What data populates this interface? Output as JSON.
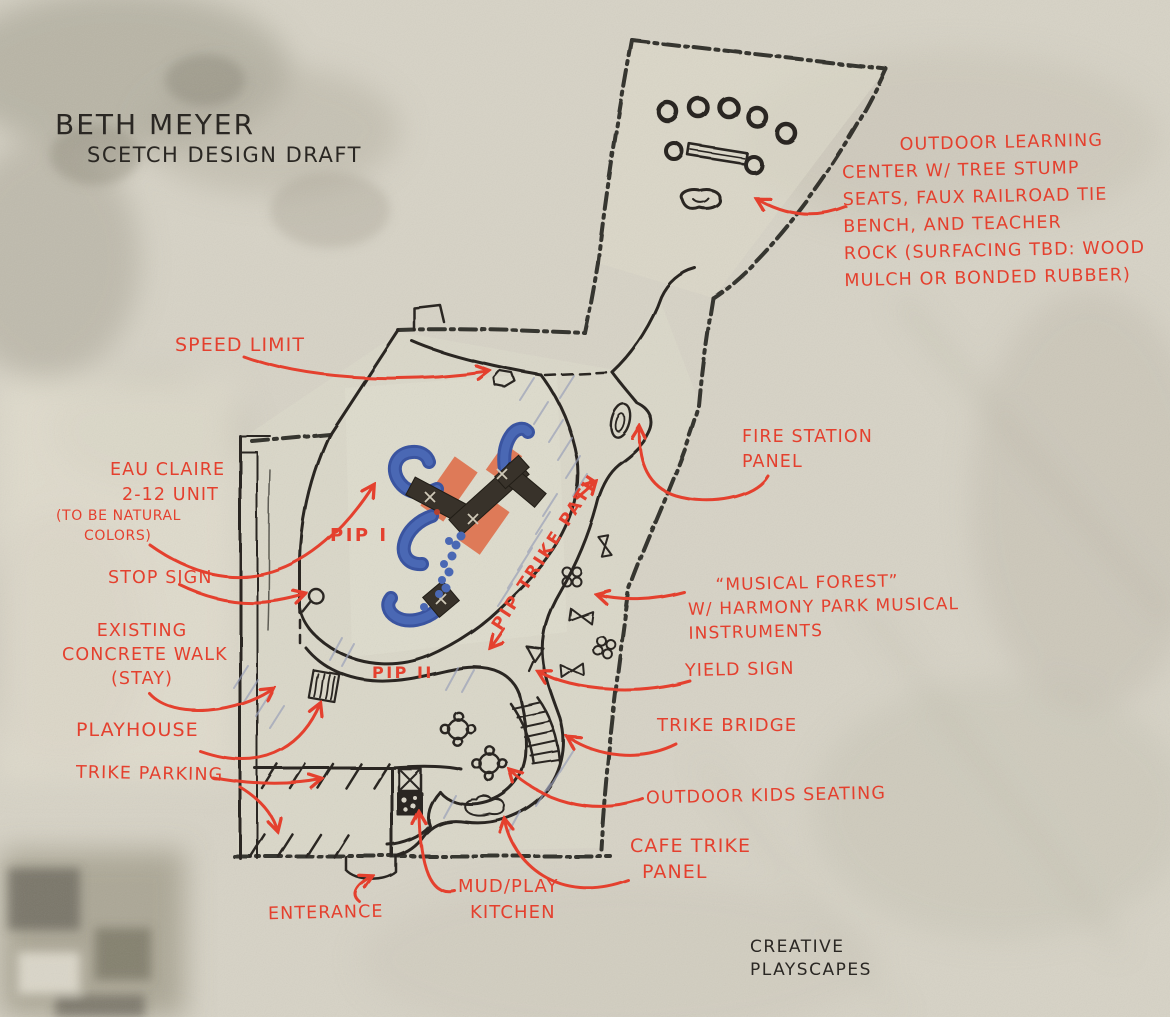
{
  "title": {
    "line1": "BETH MEYER",
    "line2": "SCETCH DESIGN DRAFT"
  },
  "credit": {
    "line1": "CREATIVE",
    "line2": "PLAYSCAPES"
  },
  "colors": {
    "annotation_red": "#e4402e",
    "ink_black": "#2a2723",
    "slide_blue": "#4a68b4",
    "ramp_orange": "#de7a58",
    "deck_brown": "#38definitely",
    "paper": "#d7d3c6"
  },
  "plan_labels": {
    "pip_1": "PIP I",
    "pip_2": "PIP II",
    "pip_trike_path": "PIP TRIKE PATH"
  },
  "annotations": {
    "speed_limit": {
      "lines": [
        "SPEED LIMIT"
      ]
    },
    "outdoor_learning": {
      "lines": [
        "OUTDOOR  LEARNING",
        "CENTER  W/  TREE STUMP",
        "SEATS, FAUX RAILROAD TIE",
        "BENCH,  AND  TEACHER",
        "ROCK    (SURFACING TBD: WOOD",
        "MULCH  OR  BONDED RUBBER)"
      ]
    },
    "fire_station": {
      "lines": [
        "FIRE STATION",
        "PANEL"
      ]
    },
    "eau_claire": {
      "lines": [
        "EAU CLAIRE",
        "2-12 UNIT"
      ],
      "note": [
        "(TO BE NATURAL",
        "COLORS)"
      ]
    },
    "stop_sign": {
      "lines": [
        "STOP SIGN"
      ]
    },
    "musical_forest": {
      "lines": [
        "“MUSICAL FOREST”",
        "W/ HARMONY PARK MUSICAL",
        "INSTRUMENTS"
      ]
    },
    "existing_walk": {
      "lines": [
        "EXISTING",
        "CONCRETE WALK",
        "(STAY)"
      ]
    },
    "yield_sign": {
      "lines": [
        "YIELD SIGN"
      ]
    },
    "playhouse": {
      "lines": [
        "PLAYHOUSE"
      ]
    },
    "trike_bridge": {
      "lines": [
        "TRIKE  BRIDGE"
      ]
    },
    "trike_parking": {
      "lines": [
        "TRIKE PARKING"
      ]
    },
    "outdoor_kids_seating": {
      "lines": [
        "OUTDOOR KIDS SEATING"
      ]
    },
    "cafe_trike_panel": {
      "lines": [
        "CAFE TRIKE",
        "PANEL"
      ]
    },
    "mud_play_kitchen": {
      "lines": [
        "MUD/PLAY",
        "KITCHEN"
      ]
    },
    "enterance": {
      "lines": [
        "ENTERANCE"
      ]
    }
  }
}
